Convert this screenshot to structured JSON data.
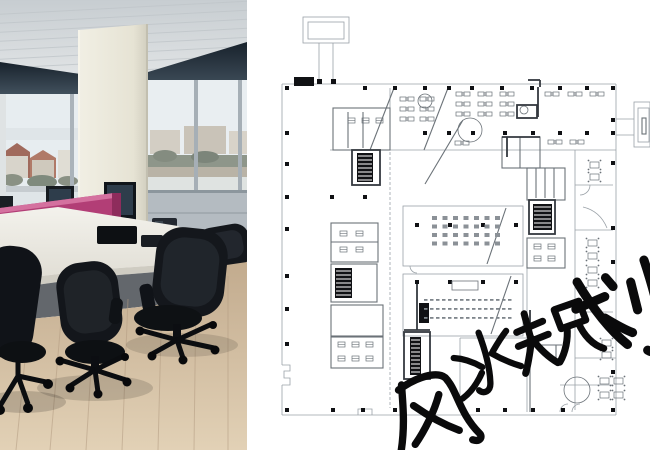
{
  "watermark": {
    "text": "风水规划",
    "chars": [
      "风",
      "水",
      "规",
      "划"
    ],
    "color": "#0a0a0b",
    "placements": [
      {
        "char": "风",
        "x": 431,
        "y": 414,
        "rot": -15,
        "scale": 1.05
      },
      {
        "char": "水",
        "x": 487,
        "y": 364,
        "rot": -15,
        "scale": 0.9
      },
      {
        "char": "规",
        "x": 557,
        "y": 336,
        "rot": -15,
        "scale": 1.0
      },
      {
        "char": "划",
        "x": 625,
        "y": 313,
        "rot": -14,
        "scale": 1.3
      }
    ]
  },
  "palette": {
    "pink_partition": "#b23e76",
    "floor_wood": "#cdb394",
    "desk_white": "#eae8e2",
    "chair_black": "#15171b",
    "window_band": "#2c3945",
    "plan_wall_light": "#9aa1a7",
    "plan_wall_mid": "#6b7278",
    "plan_wall_dark": "#34393f",
    "plan_black": "#101114",
    "paper": "#ffffff"
  },
  "plan": {
    "columns": [
      [
        287,
        88
      ],
      [
        365,
        88
      ],
      [
        395,
        88
      ],
      [
        425,
        88
      ],
      [
        449,
        88
      ],
      [
        472,
        88
      ],
      [
        502,
        88
      ],
      [
        532,
        88
      ],
      [
        560,
        88
      ],
      [
        587,
        88
      ],
      [
        613,
        88
      ],
      [
        287,
        133
      ],
      [
        425,
        133
      ],
      [
        449,
        133
      ],
      [
        473,
        133
      ],
      [
        505,
        133
      ],
      [
        533,
        133
      ],
      [
        560,
        133
      ],
      [
        587,
        133
      ],
      [
        613,
        120
      ],
      [
        613,
        133
      ],
      [
        287,
        164
      ],
      [
        287,
        197
      ],
      [
        287,
        229
      ],
      [
        287,
        276
      ],
      [
        287,
        309
      ],
      [
        287,
        344
      ],
      [
        287,
        410
      ],
      [
        332,
        197
      ],
      [
        365,
        197
      ],
      [
        417,
        225
      ],
      [
        450,
        225
      ],
      [
        483,
        225
      ],
      [
        516,
        225
      ],
      [
        417,
        282
      ],
      [
        450,
        282
      ],
      [
        483,
        282
      ],
      [
        516,
        282
      ],
      [
        613,
        163
      ],
      [
        613,
        228
      ],
      [
        613,
        262
      ],
      [
        613,
        333
      ],
      [
        613,
        372
      ],
      [
        333,
        410
      ],
      [
        363,
        410
      ],
      [
        395,
        410
      ],
      [
        478,
        410
      ],
      [
        505,
        410
      ],
      [
        533,
        410
      ],
      [
        563,
        410
      ],
      [
        613,
        410
      ]
    ],
    "lines_light": [
      [
        282,
        84,
        616,
        84
      ],
      [
        616,
        84,
        616,
        415
      ],
      [
        616,
        415,
        282,
        415
      ],
      [
        282,
        84,
        282,
        365
      ],
      [
        282,
        385,
        282,
        415
      ],
      [
        319,
        43,
        319,
        81
      ],
      [
        333,
        43,
        333,
        81
      ],
      [
        616,
        119,
        634,
        119
      ],
      [
        616,
        135,
        634,
        135
      ],
      [
        330,
        150,
        616,
        150
      ],
      [
        390,
        88,
        390,
        150
      ],
      [
        575,
        150,
        575,
        410
      ],
      [
        575,
        185,
        613,
        185
      ],
      [
        575,
        230,
        613,
        230
      ],
      [
        575,
        312,
        613,
        312
      ],
      [
        575,
        358,
        616,
        358
      ],
      [
        560,
        385,
        613,
        385
      ],
      [
        527,
        268,
        527,
        412
      ],
      [
        460,
        338,
        527,
        338
      ],
      [
        460,
        338,
        460,
        412
      ]
    ],
    "lines_dash": [
      [
        390,
        152,
        390,
        408
      ]
    ],
    "lines_mid": [
      [
        394,
        88,
        370,
        150
      ],
      [
        448,
        88,
        424,
        150
      ],
      [
        463,
        120,
        425,
        184
      ],
      [
        506,
        208,
        487,
        264
      ],
      [
        511,
        276,
        491,
        334
      ],
      [
        348,
        112,
        348,
        148
      ],
      [
        363,
        112,
        363,
        148
      ],
      [
        536,
        168,
        536,
        198
      ],
      [
        545,
        168,
        545,
        198
      ],
      [
        554,
        168,
        554,
        198
      ],
      [
        520,
        137,
        520,
        168
      ],
      [
        331,
        242,
        378,
        242
      ],
      [
        331,
        336,
        383,
        336
      ],
      [
        530,
        332,
        530,
        412
      ],
      [
        530,
        345,
        562,
        345
      ],
      [
        556,
        345,
        556,
        358
      ]
    ],
    "lines_dark": [
      [
        538,
        87,
        538,
        117
      ],
      [
        528,
        80,
        540,
        80
      ],
      [
        540,
        80,
        540,
        87
      ],
      [
        502,
        137,
        540,
        137
      ],
      [
        507,
        137,
        507,
        157
      ],
      [
        417,
        280,
        417,
        330
      ],
      [
        404,
        330,
        430,
        330
      ],
      [
        530,
        310,
        530,
        332
      ]
    ],
    "rects_light": [
      [
        303,
        17,
        46,
        26
      ],
      [
        308,
        22,
        36,
        17
      ],
      [
        634,
        102,
        16,
        45
      ],
      [
        638,
        108,
        11,
        34
      ],
      [
        403,
        206,
        120,
        60
      ],
      [
        403,
        274,
        120,
        62
      ]
    ],
    "rects_mid": [
      [
        333,
        108,
        57,
        42
      ],
      [
        331,
        223,
        47,
        39
      ],
      [
        331,
        264,
        46,
        38
      ],
      [
        331,
        305,
        52,
        31
      ],
      [
        331,
        337,
        52,
        31
      ],
      [
        527,
        168,
        38,
        32
      ],
      [
        527,
        238,
        38,
        30
      ],
      [
        502,
        137,
        38,
        31
      ],
      [
        642,
        118,
        4,
        16
      ]
    ],
    "rects_dark": [
      [
        352,
        150,
        28,
        35
      ],
      [
        404,
        332,
        26,
        47
      ],
      [
        529,
        200,
        26,
        34
      ],
      [
        517,
        105,
        20,
        13
      ]
    ],
    "stairs": [
      [
        357,
        153,
        16,
        29
      ],
      [
        335,
        268,
        17,
        30
      ],
      [
        410,
        337,
        11,
        38
      ],
      [
        533,
        204,
        19,
        26
      ]
    ],
    "black_rects": [
      [
        294,
        77,
        20,
        9
      ],
      [
        317,
        79,
        5,
        5
      ],
      [
        331,
        79,
        5,
        5
      ],
      [
        419,
        303,
        10,
        20
      ]
    ],
    "circles": [
      [
        470,
        130,
        12
      ],
      [
        425,
        101,
        7
      ],
      [
        577,
        390,
        13
      ],
      [
        524,
        110,
        4
      ]
    ],
    "paths_light": [
      "M590,185 a10,10 0 0 1 -10,10",
      "M583,207 Q600,211 607,228",
      "M410,266 a7,7 0 0 0 7,7",
      "M560,412 a8,8 0 0 1 8,-8",
      "M572,412 a8,8 0 0 1 8,-8",
      "M282,365 h8 v6 h-6 v7 h6 v7 h-8",
      "M358,415 v-6 h14 v6"
    ],
    "seats_grid": {
      "x": 432,
      "y": 216,
      "cols": 7,
      "rows": 4,
      "dx": 10.5,
      "dy": 8.5,
      "w": 5,
      "h": 4
    },
    "seat_rows": {
      "x": 424,
      "y": 299,
      "cols": 15,
      "rows": 3,
      "dx": 6,
      "dy": 9,
      "w": 3.5,
      "h": 1.8
    },
    "podium": [
      452,
      281,
      26,
      9
    ],
    "desk_pairs": [
      [
        456,
        92
      ],
      [
        478,
        92
      ],
      [
        500,
        92
      ],
      [
        456,
        102
      ],
      [
        478,
        102
      ],
      [
        500,
        102
      ],
      [
        456,
        112
      ],
      [
        478,
        112
      ],
      [
        500,
        112
      ],
      [
        400,
        97
      ],
      [
        420,
        97
      ],
      [
        400,
        107
      ],
      [
        420,
        107
      ],
      [
        400,
        117
      ],
      [
        420,
        117
      ],
      [
        545,
        92
      ],
      [
        568,
        92
      ],
      [
        590,
        92
      ],
      [
        548,
        140
      ],
      [
        570,
        140
      ],
      [
        455,
        141
      ]
    ],
    "tables": [
      [
        590,
        162
      ],
      [
        590,
        174
      ],
      [
        588,
        240
      ],
      [
        588,
        253
      ],
      [
        588,
        267
      ],
      [
        588,
        280
      ],
      [
        602,
        340
      ],
      [
        602,
        352
      ],
      [
        600,
        378
      ],
      [
        614,
        378
      ],
      [
        600,
        392
      ],
      [
        614,
        392
      ]
    ],
    "fixtures": [
      [
        340,
        231
      ],
      [
        356,
        231
      ],
      [
        340,
        247
      ],
      [
        356,
        247
      ],
      [
        534,
        244
      ],
      [
        548,
        244
      ],
      [
        534,
        256
      ],
      [
        548,
        256
      ],
      [
        338,
        342
      ],
      [
        352,
        342
      ],
      [
        366,
        342
      ],
      [
        338,
        356
      ],
      [
        352,
        356
      ],
      [
        366,
        356
      ],
      [
        348,
        118
      ],
      [
        362,
        118
      ],
      [
        376,
        118
      ]
    ]
  }
}
